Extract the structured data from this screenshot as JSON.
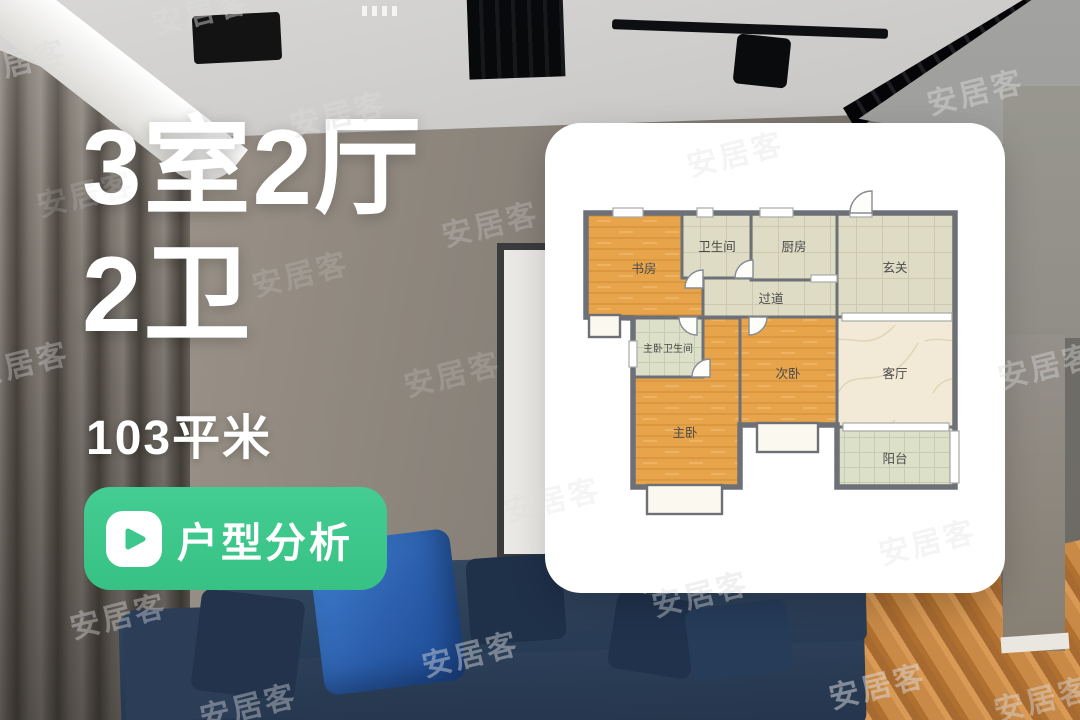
{
  "headline": {
    "line1": "3室2厅",
    "line2": "2卫",
    "area": "103平米"
  },
  "analysis_button": {
    "label": "户型分析",
    "color": "#3cc88c",
    "icon": "play-icon"
  },
  "watermark": {
    "text": "安居客",
    "items": [
      {
        "x": 200,
        "y": 10,
        "o": 0.45
      },
      {
        "x": 18,
        "y": 60,
        "o": 0.4
      },
      {
        "x": 338,
        "y": 112,
        "o": 0.4
      },
      {
        "x": 975,
        "y": 90,
        "o": 0.45
      },
      {
        "x": 735,
        "y": 152,
        "o": 0.3
      },
      {
        "x": 85,
        "y": 192,
        "o": 0.18
      },
      {
        "x": 490,
        "y": 222,
        "o": 0.25
      },
      {
        "x": 300,
        "y": 272,
        "o": 0.18
      },
      {
        "x": 20,
        "y": 362,
        "o": 0.35
      },
      {
        "x": 452,
        "y": 372,
        "o": 0.2
      },
      {
        "x": 1046,
        "y": 364,
        "o": 0.4
      },
      {
        "x": 552,
        "y": 498,
        "o": 0.28
      },
      {
        "x": 927,
        "y": 540,
        "o": 0.3
      },
      {
        "x": 700,
        "y": 592,
        "o": 0.4
      },
      {
        "x": 118,
        "y": 614,
        "o": 0.4
      },
      {
        "x": 470,
        "y": 652,
        "o": 0.45
      },
      {
        "x": 248,
        "y": 704,
        "o": 0.4
      },
      {
        "x": 877,
        "y": 684,
        "o": 0.5
      },
      {
        "x": 1042,
        "y": 697,
        "o": 0.45
      }
    ]
  },
  "floorplan": {
    "wall_color": "#6d7077",
    "rooms": [
      {
        "id": "study",
        "label": "书房",
        "x": 41,
        "y": 90,
        "w": 117,
        "h": 104,
        "floor": "wood",
        "lx": 99,
        "ly": 150
      },
      {
        "id": "master-bedroom",
        "label": "主卧",
        "x": 88,
        "y": 195,
        "w": 107,
        "h": 169,
        "floor": "wood",
        "lx": 140,
        "ly": 314
      },
      {
        "id": "master-bathroom",
        "label": "主卧卫生间",
        "x": 88,
        "y": 195,
        "w": 70,
        "h": 59,
        "floor": "tile-green",
        "lx": 123,
        "ly": 229,
        "small": true
      },
      {
        "id": "second-bedroom",
        "label": "次卧",
        "x": 195,
        "y": 194,
        "w": 97,
        "h": 108,
        "floor": "wood",
        "lx": 243,
        "ly": 255
      },
      {
        "id": "living-room",
        "label": "客厅",
        "x": 292,
        "y": 194,
        "w": 118,
        "h": 110,
        "floor": "marble",
        "lx": 350,
        "ly": 255
      },
      {
        "id": "entry",
        "label": "玄关",
        "x": 292,
        "y": 90,
        "w": 118,
        "h": 104,
        "floor": "tile",
        "lx": 350,
        "ly": 149
      },
      {
        "id": "hallway",
        "label": "过道",
        "x": 158,
        "y": 155,
        "w": 134,
        "h": 39,
        "floor": "tile",
        "lx": 226,
        "ly": 180
      },
      {
        "id": "bathroom",
        "label": "卫生间",
        "x": 137,
        "y": 90,
        "w": 69,
        "h": 65,
        "floor": "tile",
        "lx": 172,
        "ly": 128
      },
      {
        "id": "kitchen",
        "label": "厨房",
        "x": 206,
        "y": 90,
        "w": 86,
        "h": 67,
        "floor": "tile",
        "lx": 249,
        "ly": 128
      },
      {
        "id": "balcony",
        "label": "阳台",
        "x": 292,
        "y": 304,
        "w": 117,
        "h": 60,
        "floor": "tile-green",
        "lx": 350,
        "ly": 340
      }
    ],
    "outline": "M41,90 L410,90 L410,364 L292,364 L292,302 L195,302 L195,364 L88,364 L88,195 L41,194 Z",
    "windows": [
      {
        "x": 68,
        "y": 85,
        "w": 30,
        "h": 9
      },
      {
        "x": 152,
        "y": 85,
        "w": 16,
        "h": 9
      },
      {
        "x": 215,
        "y": 85,
        "w": 33,
        "h": 9
      },
      {
        "x": 305,
        "y": 86,
        "w": 22,
        "h": 8
      },
      {
        "x": 44,
        "y": 192,
        "w": 31,
        "h": 22
      },
      {
        "x": 102,
        "y": 362,
        "w": 75,
        "h": 29
      },
      {
        "x": 212,
        "y": 300,
        "w": 61,
        "h": 29
      },
      {
        "x": 405,
        "y": 308,
        "w": 9,
        "h": 52
      },
      {
        "x": 84,
        "y": 218,
        "w": 8,
        "h": 26
      },
      {
        "x": 297,
        "y": 190,
        "w": 110,
        "h": 8
      },
      {
        "x": 298,
        "y": 300,
        "w": 106,
        "h": 8
      },
      {
        "x": 266,
        "y": 152,
        "w": 26,
        "h": 7
      }
    ],
    "doors": [
      {
        "id": "entry-door",
        "d": "M305,90 A22,22 0 0 1 327,68 L327,90 Z"
      },
      {
        "id": "study-door",
        "d": "M158,147 A18,18 0 0 0 140,165 L158,165 Z"
      },
      {
        "id": "bathroom-door",
        "d": "M190,155 A18,18 0 0 1 208,137 L208,155 Z"
      },
      {
        "id": "second-bedroom-door",
        "d": "M222,194 A18,18 0 0 1 204,212 L204,194 Z"
      },
      {
        "id": "master-hall-door",
        "d": "M134,194 A18,18 0 0 0 152,212 L152,194 Z"
      },
      {
        "id": "master-bath-door",
        "d": "M147,254 A18,18 0 0 1 165,236 L165,254 Z"
      }
    ]
  }
}
